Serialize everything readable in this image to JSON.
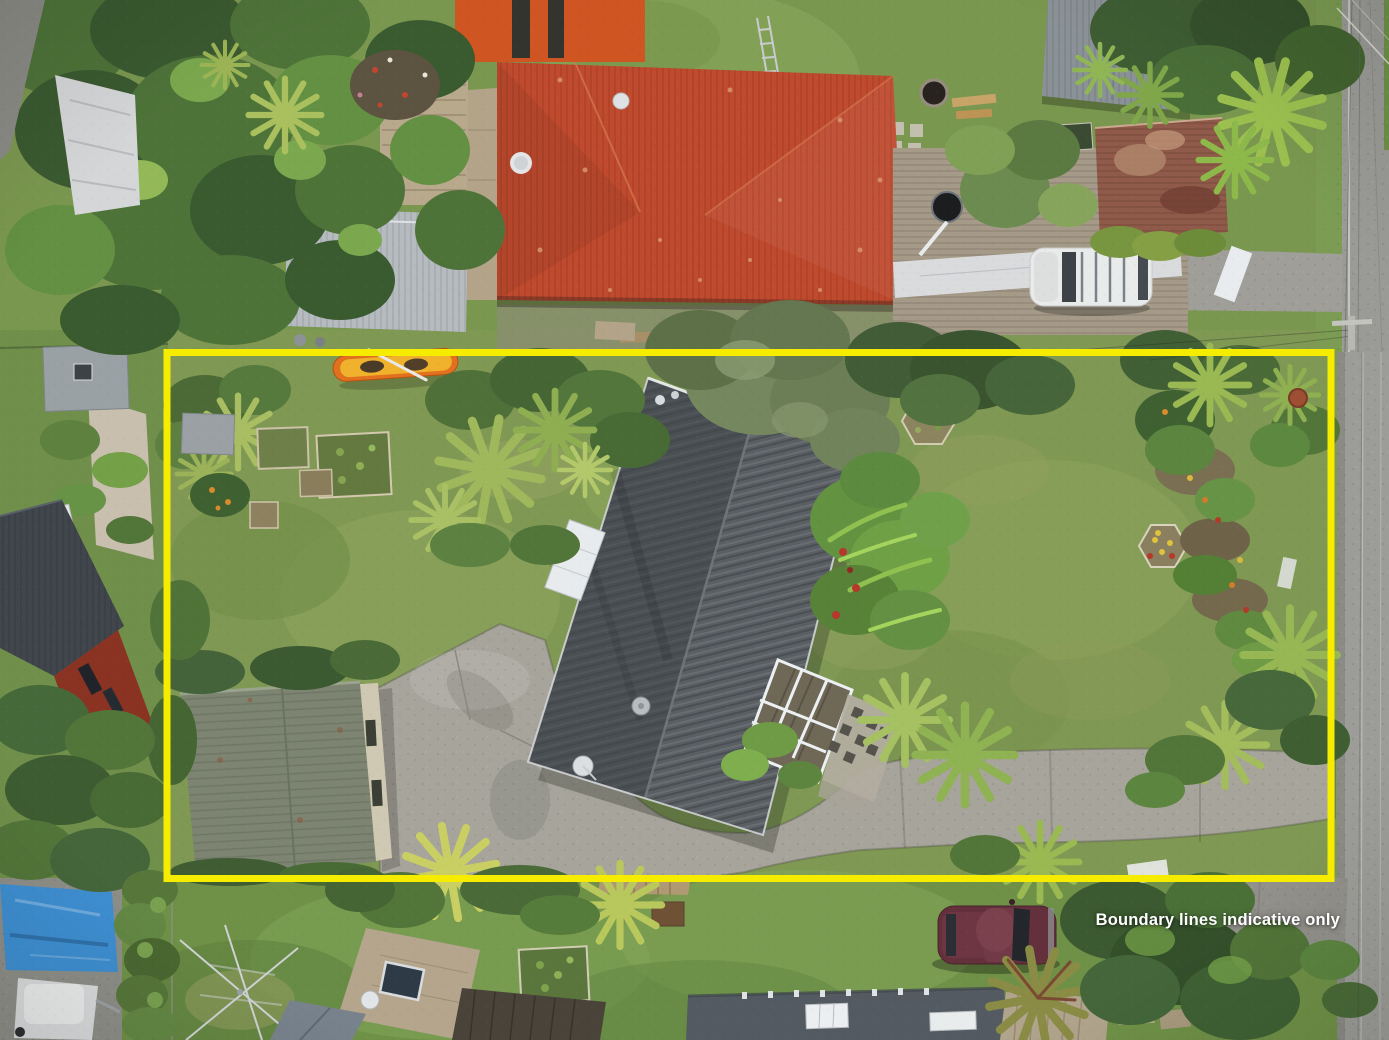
{
  "overlay": {
    "disclaimer": "Boundary lines indicative only",
    "boundary_color": "#F6EC00",
    "text_color": "#FFFFFF"
  },
  "scene": {
    "type": "aerial-drone-photograph",
    "subject": "residential property outlined with indicative boundary",
    "features": [
      {
        "name": "yellow-boundary-outline",
        "color": "#F6EC00"
      },
      {
        "name": "main-house-dark-grey-roof"
      },
      {
        "name": "green-roof-garage"
      },
      {
        "name": "concrete-driveway"
      },
      {
        "name": "red-roof-neighbour-house"
      },
      {
        "name": "grey-roof-neighbour-house"
      },
      {
        "name": "rusty-corrugated-shed"
      },
      {
        "name": "street-right-edge"
      },
      {
        "name": "white-vehicle-on-driveway"
      },
      {
        "name": "maroon-car-on-lawn"
      },
      {
        "name": "yellow-orange-kayak"
      },
      {
        "name": "vegetable-garden-beds"
      },
      {
        "name": "rotary-clothesline"
      },
      {
        "name": "blue-tarp"
      },
      {
        "name": "palm-trees-and-hedges"
      }
    ]
  }
}
